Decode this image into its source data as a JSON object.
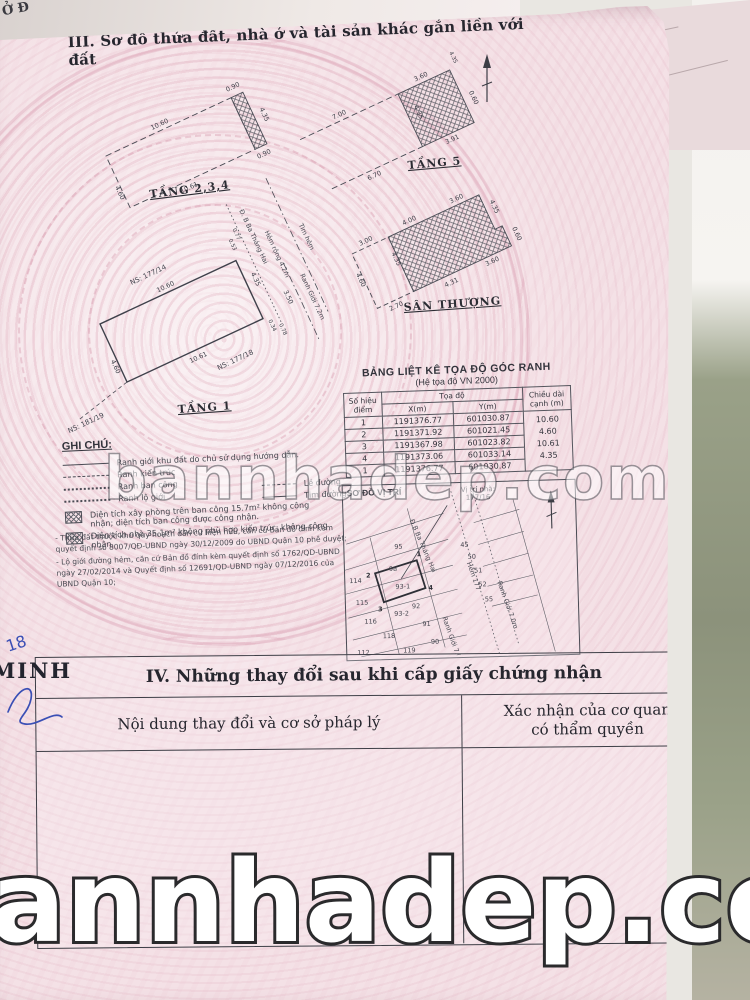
{
  "page_title": "III. Sơ đồ thửa đất, nhà ở và tài sản khác gắn liền với đất",
  "corner_fragment": "Ở Đ",
  "plans": {
    "t234": {
      "label": "TẦNG 2,3,4",
      "top": "10.60",
      "bottom": "10.61",
      "left": "4.60",
      "hatch_top": "0.90",
      "hatch_side": "4.35",
      "hatch_bottom": "0.90"
    },
    "t5": {
      "label": "TẦNG 5",
      "top": "3.60",
      "bottom": "3.91",
      "side": "4.35",
      "right": "0.60",
      "corner": "4.35",
      "ext_top": "7.00",
      "ext_bottom": "6.70"
    },
    "santhuong": {
      "label": "SÂN THƯỢNG",
      "ext_top": "3.00",
      "ext_left": "4.60",
      "ext_bottom": "2.70",
      "hatch_left": "4.35",
      "top_left": "4.00",
      "top_right": "3.60",
      "right": "4.35",
      "step": "0.60",
      "bottom_right": "3.60",
      "bottom": "4.31"
    },
    "t1": {
      "label": "TẦNG 1",
      "top": "10.60",
      "bottom": "10.61",
      "left": "4.60",
      "right": "4.35",
      "ns_top": "NS: 177/14",
      "ns_bottom": "NS: 177/18",
      "ns_corner": "NS: 181/19",
      "street": "Đ. B Ba Tháng Hai",
      "alley": "Hẻm rộng 4.2m",
      "tim_hem": "Tim hẻm",
      "ranh_gioi": "Ranh Giới 7.2m",
      "d1": "0.53",
      "d2": "0.77",
      "d3": "0.34",
      "d4": "0.78",
      "d5": "3.50"
    }
  },
  "coord_table": {
    "title": "BẢNG LIỆT KÊ TỌA ĐỘ GÓC RANH",
    "subtitle": "(Hệ tọa độ VN 2000)",
    "col_point": "Số hiệu điểm",
    "col_coord": "Tọa độ",
    "col_x": "X(m)",
    "col_y": "Y(m)",
    "col_len": "Chiều dài cạnh (m)",
    "rows": [
      {
        "point": "1",
        "x": "1191376.77",
        "y": "601030.87",
        "len": ""
      },
      {
        "point": "2",
        "x": "1191371.92",
        "y": "601021.45",
        "len": "10.60"
      },
      {
        "point": "3",
        "x": "1191367.98",
        "y": "601023.82",
        "len": "4.60"
      },
      {
        "point": "4",
        "x": "1191373.06",
        "y": "601033.14",
        "len": "10.61"
      },
      {
        "point": "1",
        "x": "1191376.77",
        "y": "601030.87",
        "len": "4.35"
      }
    ]
  },
  "legend": {
    "title": "GHI CHÚ:",
    "item_boundary": "Ranh giới khu đất do chủ sử dụng hướng dẫn.",
    "item_arch": "Ranh kiến trúc",
    "item_balcony": "Ranh ban công",
    "item_logioi": "Ranh lộ giới",
    "le_duong": "Lề đường",
    "tim_duong": "Tim đường",
    "hatch_note_1": "Diện tích xây phòng trên ban công 15.7m² không công nhận; diện tích ban công được công nhận.",
    "hatch_note_2": "Diện tích nhà 35.1m² không phù hợp kiến trúc, không công nhận.",
    "note_1": "- Thửa đất thuộc khu quy hoạch dân cư hiện hữu, căn cứ Bản đồ đính kèm quyết định số 8007/QĐ-UBND ngày 30/12/2009 do UBND Quận 10 phê duyệt;",
    "note_2": "- Lộ giới đường hẻm, căn cứ Bản đồ đính kèm quyết định số 1762/QD-UBND ngày 27/02/2014 và Quyết định số 12691/QD-UBND ngày 07/12/2016 của UBND Quận 10;"
  },
  "map": {
    "title": "SƠ ĐỒ VỊ TRÍ",
    "vi_tri_label": "Vị trí nhà:",
    "vi_tri_value": "177/16",
    "street": "Đ.B Ba Tháng Hai",
    "hem": "Hẻm 177",
    "ranh_gioi_1": "Ranh Giới 7.0m",
    "ranh_gioi_2": "Ranh Giới 7.0m",
    "parcels": [
      "95",
      "9a",
      "114",
      "115",
      "116",
      "118",
      "119",
      "112",
      "92",
      "93-1",
      "93-2",
      "91",
      "90",
      "45",
      "50",
      "51",
      "52",
      "55"
    ],
    "corners": [
      "1",
      "2",
      "3",
      "4"
    ]
  },
  "section4": {
    "title": "IV. Những thay đổi sau khi cấp giấy chứng nhận",
    "col1": "Nội dung thay đổi và cơ sở pháp lý",
    "col2": "Xác nhận của cơ quan\ncó thẩm quyền"
  },
  "watermark": {
    "middle": "bannhadep.com",
    "bottom": "annhadep.com"
  },
  "margin": {
    "number": "18",
    "stamp": "MINH"
  }
}
